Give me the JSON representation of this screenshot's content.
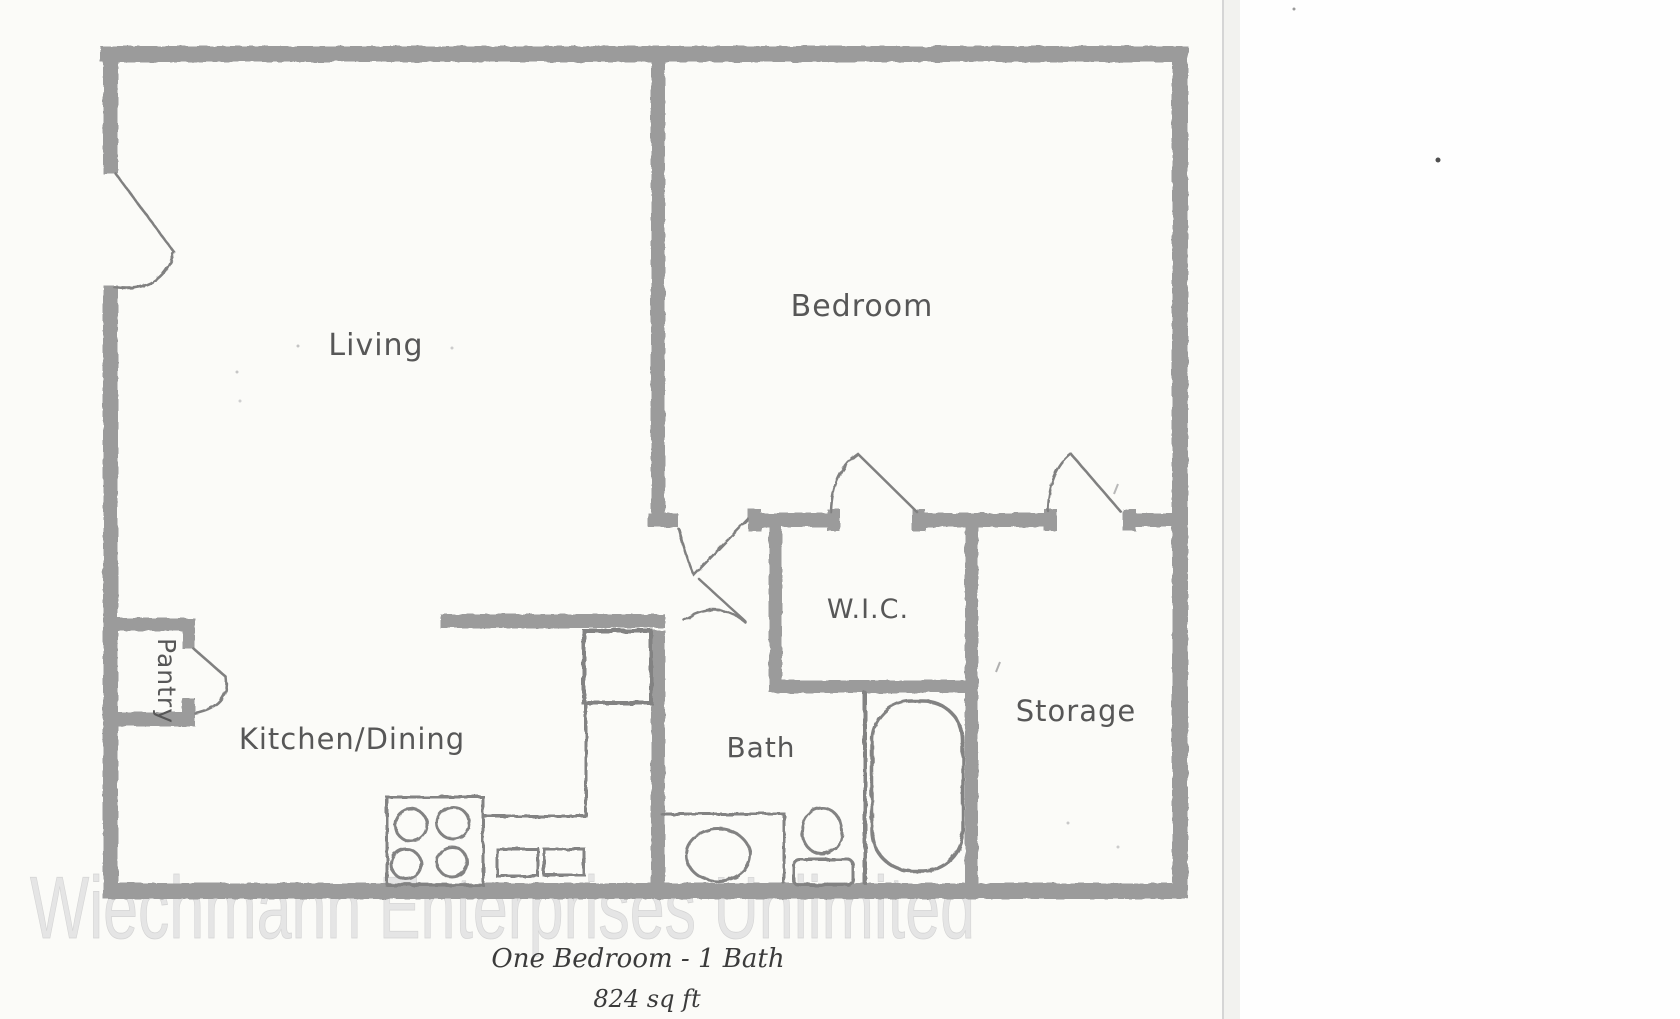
{
  "floor_plan": {
    "room_labels": [
      {
        "id": "living",
        "label": "Living"
      },
      {
        "id": "bedroom",
        "label": "Bedroom"
      },
      {
        "id": "wic",
        "label": "W.I.C."
      },
      {
        "id": "storage",
        "label": "Storage"
      },
      {
        "id": "bath",
        "label": "Bath"
      },
      {
        "id": "kitchen-dining",
        "label": "Kitchen/Dining"
      },
      {
        "id": "pantry",
        "label": "Pantry"
      }
    ],
    "captions": {
      "title": "One Bedroom - 1 Bath",
      "area": "824 sq ft"
    },
    "colors": {
      "wall": "#9b9b9b",
      "fixture_line": "#828282",
      "door_line": "#808080",
      "label_text": "#575757",
      "caption_text": "#3b3b3b",
      "paper": "#fbfbf8",
      "scanner_margin": "#fefefe",
      "paper_edge_line": "#d5d5d5",
      "watermark": "#e5e5e5"
    }
  },
  "watermark": {
    "text": "Wiechmann Enterprises Unlimited"
  }
}
